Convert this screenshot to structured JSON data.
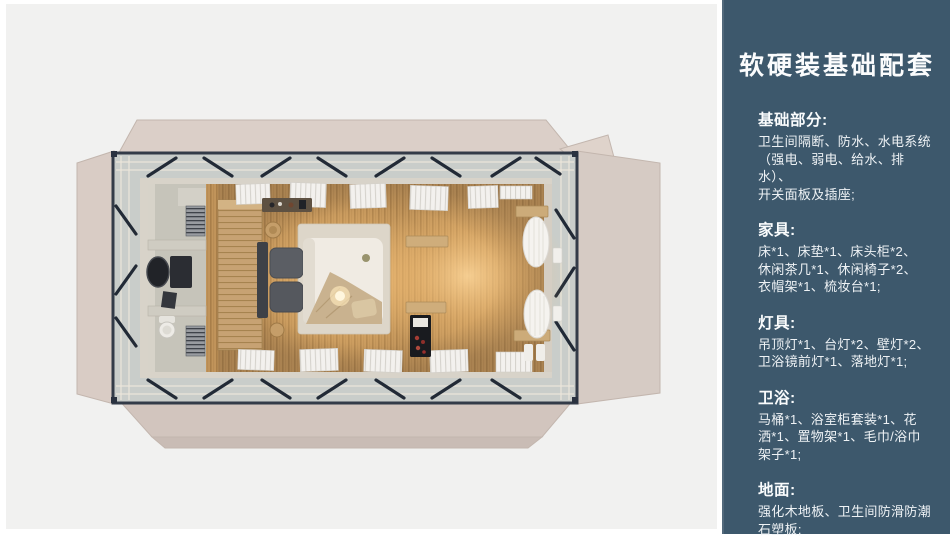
{
  "page": {
    "background_color": "#f1f1f0",
    "accent_color": "#3d586c",
    "text_color": "#f3f6f8"
  },
  "sidebar": {
    "title": "软硬装基础配套",
    "sections": [
      {
        "heading": "基础部分:",
        "text": "卫生间隔断、防水、水电系统\n（强电、弱电、给水、排水）、\n开关面板及插座;"
      },
      {
        "heading": "家具:",
        "text": "床*1、床垫*1、床头柜*2、\n休闲茶几*1、休闲椅子*2、\n衣帽架*1、梳妆台*1;"
      },
      {
        "heading": "灯具:",
        "text": "吊顶灯*1、台灯*2、壁灯*2、\n卫浴镜前灯*1、落地灯*1;"
      },
      {
        "heading": "卫浴:",
        "text": "马桶*1、浴室柜套装*1、花\n洒*1、置物架*1、毛巾/浴巾\n架子*1;"
      },
      {
        "heading": "地面:",
        "text": "强化木地板、卫生间防滑防潮\n石塑板;"
      }
    ]
  }
}
